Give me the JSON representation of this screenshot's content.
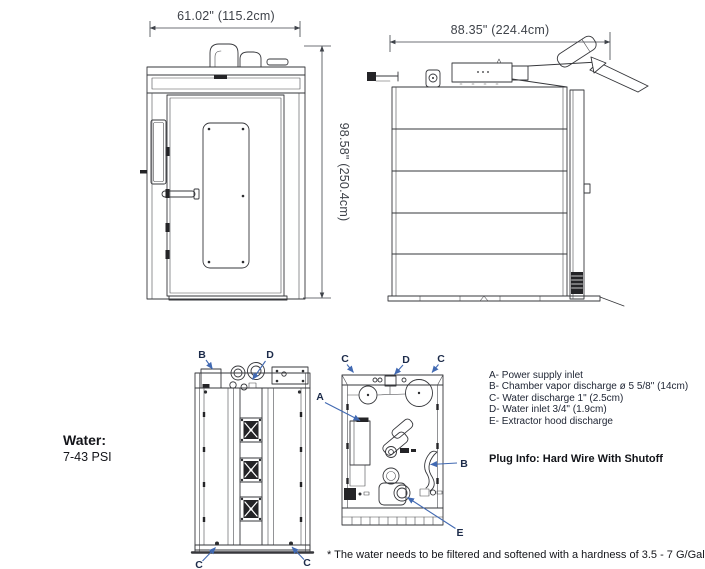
{
  "colors": {
    "line": "#36373b",
    "dimension_text": "#3f434a",
    "diagram_label": "#1c2b4a",
    "arrow": "#4169b2",
    "body_text": "#14151a",
    "background": "#ffffff"
  },
  "front_view": {
    "name": "front-elevation",
    "width_dim": "61.02\" (115.2cm)",
    "height_dim": "98.58\" (250.4cm)"
  },
  "side_view": {
    "name": "side-elevation",
    "width_dim": "88.35\" (224.4cm)"
  },
  "back_view": {
    "labels": {
      "b": "B",
      "d": "D",
      "c_left": "C",
      "c_right": "C"
    }
  },
  "top_view": {
    "labels": {
      "c_left": "C",
      "d": "D",
      "c_right": "C",
      "a": "A",
      "b": "B",
      "e": "E"
    }
  },
  "water_spec": {
    "label": "Water:",
    "value": "7-43 PSI"
  },
  "legend": {
    "items": [
      "A- Power supply inlet",
      "B- Chamber vapor discharge ø 5 5/8\" (14cm)",
      "C- Water discharge 1\" (2.5cm)",
      "D- Water inlet 3/4\" (1.9cm)",
      "E- Extractor hood discharge"
    ],
    "plug_info": "Plug Info: Hard Wire With Shutoff"
  },
  "footnote": "* The water needs to be filtered and softened with a hardness of 3.5 - 7 G/Gal"
}
